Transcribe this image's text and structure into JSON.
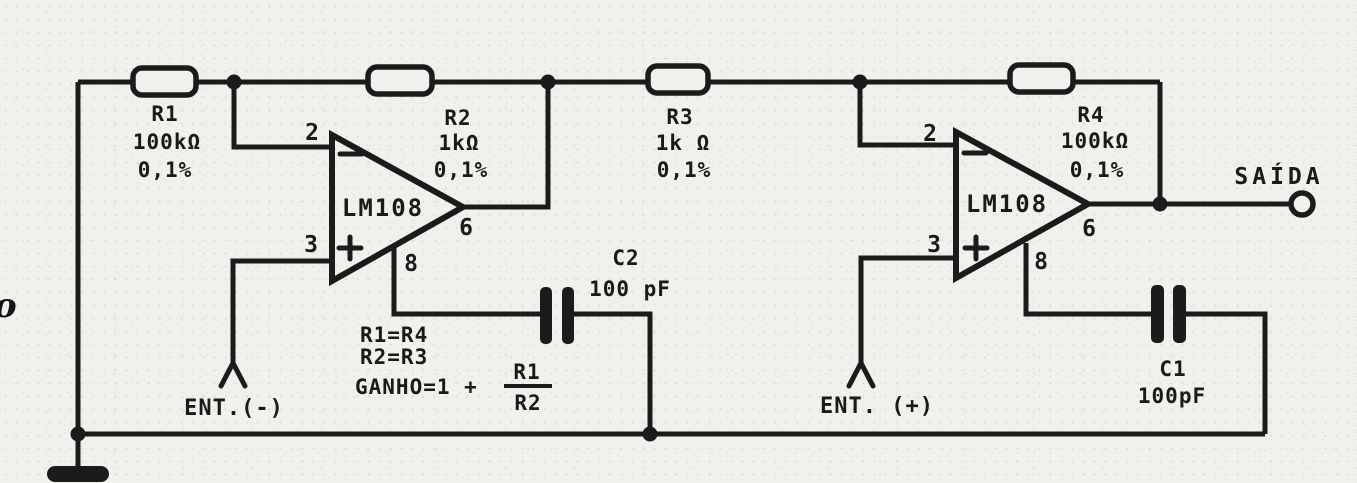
{
  "title": "Differential instrumentation amplifier schematic (two LM108 op-amps)",
  "colors": {
    "ink": "#1b1b1b",
    "paper": "#f1f0ec"
  },
  "components": {
    "r1": {
      "ref": "R1",
      "value": "100kΩ",
      "tol": "0,1%"
    },
    "r2": {
      "ref": "R2",
      "value": "1kΩ",
      "tol": "0,1%"
    },
    "r3": {
      "ref": "R3",
      "value": "1k Ω",
      "tol": "0,1%"
    },
    "r4": {
      "ref": "R4",
      "value": "100kΩ",
      "tol": "0,1%"
    },
    "c1": {
      "ref": "C1",
      "value": "100pF"
    },
    "c2": {
      "ref": "C2",
      "value": "100 pF"
    },
    "opamp1": {
      "part": "LM108",
      "pins": {
        "inverting": "2",
        "noninverting": "3",
        "output": "6",
        "comp": "8"
      }
    },
    "opamp2": {
      "part": "LM108",
      "pins": {
        "inverting": "2",
        "noninverting": "3",
        "output": "6",
        "comp": "8"
      }
    }
  },
  "terminals": {
    "input_negative": "ENT.(-)",
    "input_positive": "ENT. (+)",
    "output": "SAÍDA"
  },
  "equations": {
    "line1": "R1=R4",
    "line2": "R2=R3",
    "gain_prefix": "GANHO=1 +",
    "fraction_numerator": "R1",
    "fraction_denominator": "R2"
  },
  "annotations": {
    "stray_mark": "o"
  }
}
